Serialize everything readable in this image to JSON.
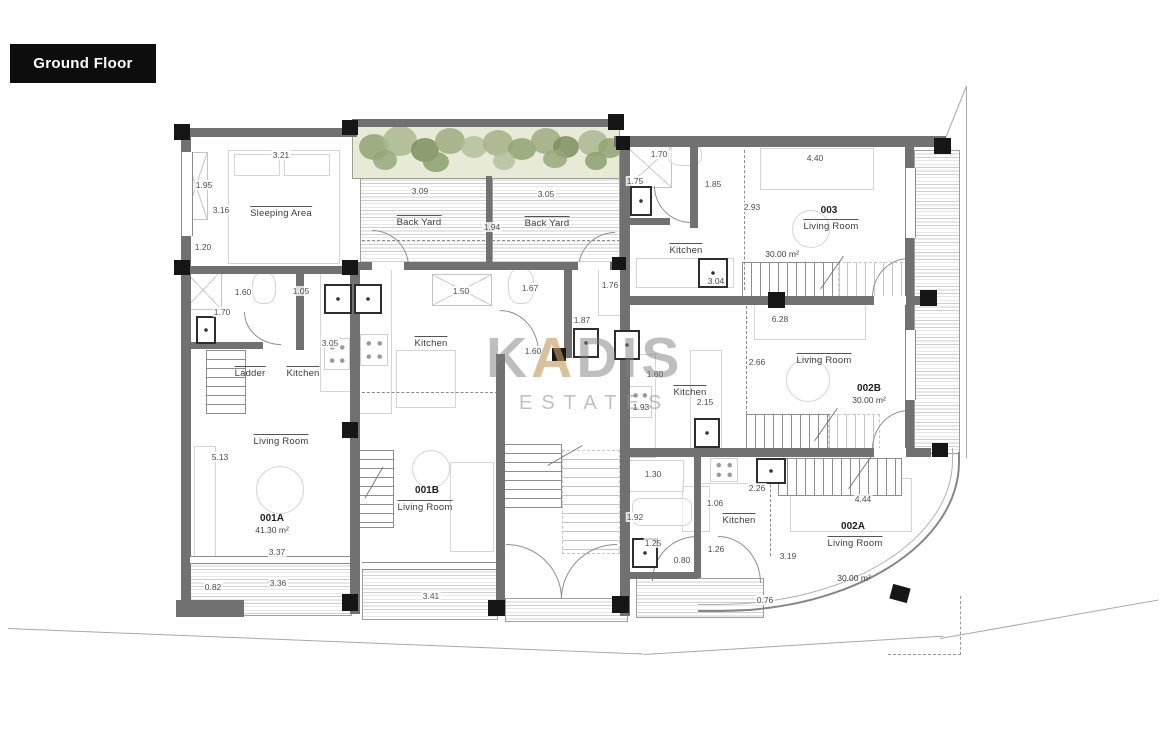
{
  "header": {
    "title": "Ground Floor"
  },
  "watermark": {
    "k": "K",
    "a": "A",
    "dis": "DIS",
    "estates": "ESTATES"
  },
  "labels": {
    "sleeping_area": "Sleeping Area",
    "back_yard_left": "Back Yard",
    "back_yard_right": "Back Yard",
    "ladder": "Ladder",
    "kitchen_001a": "Kitchen",
    "living_001a": "Living Room",
    "kitchen_001b": "Kitchen",
    "living_001b": "Living Room",
    "kitchen_003": "Kitchen",
    "living_003": "Living Room",
    "kitchen_002b": "Kitchen",
    "living_002b": "Living Room",
    "kitchen_002a": "Kitchen",
    "living_002a": "Living Room"
  },
  "units": {
    "u001a": {
      "id": "001A",
      "area": "41.30 m²"
    },
    "u001b": {
      "id": "001B"
    },
    "u002a": {
      "id": "002A",
      "area": "30.00 m²"
    },
    "u002b": {
      "id": "002B",
      "area": "30.00 m²"
    },
    "u003": {
      "id": "003",
      "area": "30.00 m²"
    }
  },
  "dims": {
    "sleep_top": "3.21",
    "sleep_left_a": "1.95",
    "sleep_left_b": "3.16",
    "sleep_left_c": "1.20",
    "bath001a_w": "1.60",
    "hall001a_w": "1.05",
    "bath001a_h": "1.70",
    "kitchen001a_h": "3.05",
    "living001a_h": "5.13",
    "living001a_w": "3.37",
    "yard001a_side": "0.82",
    "yard001a_w": "3.36",
    "byard_l_w": "3.09",
    "byard_split": "1.94",
    "byard_r_w": "3.05",
    "closet001b_w": "1.50",
    "bath001b_w": "1.67",
    "bath001b_h": "1.87",
    "bath001b_d": "1.60",
    "bath2_001b_w": "1.76",
    "yard001b_w": "3.41",
    "shower003_w": "1.70",
    "shower003_h": "1.75",
    "hall003_w": "1.85",
    "living003_d": "2.93",
    "living003_w": "4.40",
    "kitchen003_d": "3.04",
    "living002b_w": "6.28",
    "living002b_d": "2.66",
    "kitchen002b_a": "1.60",
    "kitchen002b_b": "2.15",
    "kitchen002b_c": "1.93",
    "bath002a_w": "1.30",
    "kitchen002a_w": "2.26",
    "kitchen002a_d": "1.06",
    "living002a_w": "4.44",
    "bath002a_h": "1.92",
    "bath002a_s": "1.25",
    "bath002a_d": "0.80",
    "hall002a_w": "1.26",
    "living002a_d": "3.19",
    "side002a": "0.76"
  }
}
